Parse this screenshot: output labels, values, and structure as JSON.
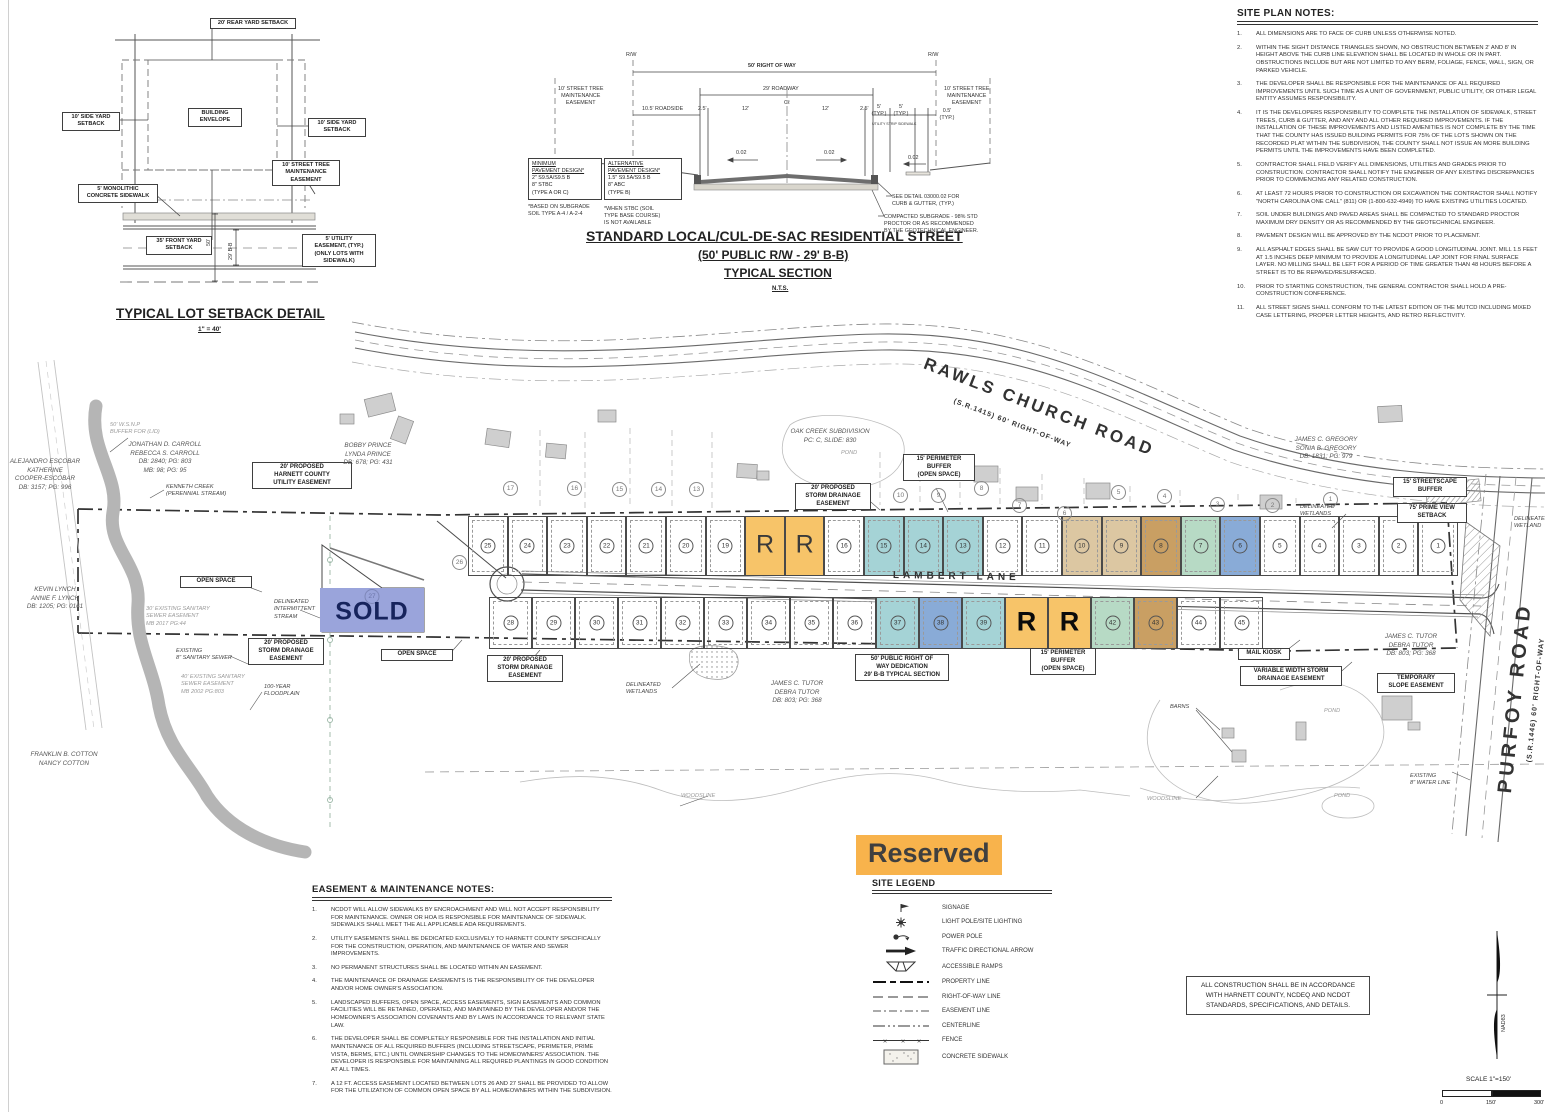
{
  "colors": {
    "teal": "#A5D3D6",
    "blue": "#89ABD7",
    "green": "#B7DAC5",
    "tan": "#DCC7A2",
    "tan_dark": "#C99F63",
    "orange": "#F7C469",
    "sold": "#9AA4DB",
    "reserved_bg": "#F8B34C"
  },
  "reserved_label": "Reserved",
  "setback_detail": {
    "title": "TYPICAL LOT SETBACK DETAIL",
    "scale": "1\" = 40'",
    "labels": {
      "rear": "20' REAR YARD SETBACK",
      "side_left": "10' SIDE YARD\nSETBACK",
      "side_right": "10' SIDE YARD\nSETBACK",
      "envelope": "BUILDING\nENVELOPE",
      "street_tree": "10' STREET TREE\nMAINTENANCE\nEASEMENT",
      "sidewalk": "5' MONOLITHIC\nCONCRETE SIDEWALK",
      "front": "35' FRONT YARD\nSETBACK",
      "utility": "5' UTILITY\nEASEMENT, (TYP.)\n(ONLY LOTS WITH\nSIDEWALK)",
      "dim50": "50'",
      "dim29": "29' B-B"
    }
  },
  "street_section": {
    "title1": "STANDARD LOCAL/CUL-DE-SAC RESIDENTIAL STREET",
    "title2": "(50' PUBLIC R/W - 29' B-B)",
    "title3": "TYPICAL SECTION",
    "nts": "N.T.S.",
    "rw_left": "R/W",
    "rw_right": "R/W",
    "row": "50' RIGHT OF WAY",
    "roadway": "29' ROADWAY",
    "maint_left": "10' STREET TREE\nMAINTENANCE\nEASEMENT",
    "maint_right": "10' STREET TREE\nMAINTENANCE\nEASEMENT",
    "roadside": "10.5' ROADSIDE",
    "d25a": "2.5'",
    "d12a": "12'",
    "cl": "Cℓ",
    "d12b": "12'",
    "d25b": "2.5'",
    "d5a": "5'\n(TYP.)",
    "utility_strip": "UTILITY STRIP",
    "d5b": "5'\n(TYP.)",
    "sidewalk_lbl": "SIDEWALK",
    "d05": "0.5'\n(TYP.)",
    "slope1": "0.02",
    "slope2": "0.02",
    "slope3": "0.02",
    "min_pavement": [
      "MINIMUM",
      "PAVEMENT DESIGN*",
      "2\" S9.5A/S9.5 B",
      "8\" STBC",
      "(TYPE A OR C)"
    ],
    "min_footnote": "*BASED ON SUBGRADE\nSOIL TYPE A-4 / A-2-4",
    "alt_pavement": [
      "ALTERNATIVE",
      "PAVEMENT DESIGN*",
      "1.5\" S9.5A/S9.5 B",
      "8\" ABC",
      "(TYPE B)"
    ],
    "alt_footnote": "*WHEN STBC (SOIL\nTYPE BASE COURSE)\nIS NOT AVAILABLE",
    "curb_callout": "SEE DETAIL 03000.02 FOR\nCURB & GUTTER, (TYP.)",
    "subgrade_callout": "COMPACTED SUBGRADE - 98% STD\nPROCTOR OR AS RECOMMENDED\nBY THE GEOTECHNICAL ENGINEER."
  },
  "site_plan_notes": {
    "title": "SITE PLAN NOTES:",
    "notes": [
      "ALL DIMENSIONS ARE TO FACE OF CURB UNLESS OTHERWISE NOTED.",
      "WITHIN THE SIGHT DISTANCE TRIANGLES SHOWN, NO OBSTRUCTION BETWEEN 2' AND 8' IN HEIGHT ABOVE THE CURB LINE ELEVATION SHALL BE LOCATED IN WHOLE OR IN PART. OBSTRUCTIONS INCLUDE BUT ARE NOT LIMITED TO ANY BERM, FOLIAGE, FENCE, WALL, SIGN, OR PARKED VEHICLE.",
      "THE DEVELOPER SHALL BE RESPONSIBLE FOR THE MAINTENANCE OF ALL REQUIRED IMPROVEMENTS UNTIL SUCH TIME AS A UNIT OF GOVERNMENT, PUBLIC UTILITY, OR OTHER LEGAL ENTITY ASSUMES RESPONSIBILITY.",
      "IT IS THE DEVELOPERS RESPONSIBILITY TO COMPLETE THE INSTALLATION OF SIDEWALK, STREET TREES, CURB & GUTTER, AND ANY AND ALL OTHER REQUIRED IMPROVEMENTS. IF THE INSTALLATION OF THESE IMPROVEMENTS AND LISTED AMENITIES IS NOT COMPLETE BY THE TIME THAT THE COUNTY HAS ISSUED BUILDING PERMITS FOR 75% OF THE LOTS SHOWN ON THE RECORDED PLAT WITHIN THE SUBDIVISION, THE COUNTY SHALL NOT ISSUE AN MORE BUILDING PERMITS UNTIL THE IMPROVEMENTS HAVE BEEN COMPLETED.",
      "CONTRACTOR SHALL FIELD VERIFY ALL DIMENSIONS, UTILITIES AND GRADES PRIOR TO CONSTRUCTION. CONTRACTOR SHALL NOTIFY THE ENGINEER OF ANY EXISTING DISCREPANCIES PRIOR TO COMMENCING ANY RELATED CONSTRUCTION.",
      "AT LEAST 72 HOURS PRIOR TO CONSTRUCTION OR EXCAVATION THE CONTRACTOR SHALL NOTIFY \"NORTH CAROLINA ONE CALL\" (811) OR (1-800-632-4949) TO HAVE EXISTING UTILITIES LOCATED.",
      "SOIL UNDER BUILDINGS AND PAVED AREAS SHALL BE COMPACTED TO STANDARD PROCTOR MAXIMUM DRY DENSITY OR AS RECOMMENDED BY THE GEOTECHNICAL ENGINEER.",
      "PAVEMENT DESIGN WILL BE APPROVED BY THE NCDOT PRIOR TO PLACEMENT.",
      "ALL ASPHALT EDGES SHALL BE SAW CUT TO PROVIDE A GOOD LONGITUDINAL JOINT.  MILL 1.5 FEET AT 1.5 INCHES DEEP MINIMUM TO PROVIDE A LONGITUDINAL LAP JOINT FOR FINAL SURFACE LAYER. NO MILLING SHALL BE LEFT FOR A PERIOD OF TIME GREATER THAN 48 HOURS BEFORE A STREET IS TO BE REPAVED/RESURFACED.",
      "PRIOR TO STARTING CONSTRUCTION, THE GENERAL CONTRACTOR SHALL HOLD A PRE-CONSTRUCTION CONFERENCE.",
      "ALL STREET SIGNS SHALL CONFORM TO THE LATEST EDITION OF THE MUTCD INCLUDING MIXED CASE LETTERING, PROPER LETTER HEIGHTS, AND RETRO REFLECTIVITY."
    ]
  },
  "easement_notes": {
    "title": "EASEMENT & MAINTENANCE NOTES:",
    "notes": [
      "NCDOT WILL ALLOW SIDEWALKS BY ENCROACHMENT AND WILL NOT ACCEPT RESPONSIBILITY FOR MAINTENANCE. OWNER OR HOA IS RESPONSIBLE FOR MAINTENANCE OF SIDEWALK. SIDEWALKS SHALL MEET THE ALL APPLICABLE ADA REQUIREMENTS.",
      "UTILITY EASEMENTS SHALL BE DEDICATED EXCLUSIVELY TO HARNETT COUNTY SPECIFICALLY FOR THE CONSTRUCTION, OPERATION, AND MAINTENANCE OF WATER AND SEWER IMPROVEMENTS.",
      "NO PERMANENT STRUCTURES SHALL BE LOCATED WITHIN AN EASEMENT.",
      "THE MAINTENANCE OF DRAINAGE EASEMENTS IS THE RESPONSIBILITY OF THE DEVELOPER AND/OR HOME OWNER'S ASSOCIATION.",
      "LANDSCAPED BUFFERS, OPEN SPACE, ACCESS EASEMENTS, SIGN EASEMENTS AND COMMON FACILITIES WILL BE RETAINED, OPERATED, AND MAINTAINED BY THE DEVELOPER AND/OR THE HOMEOWNER'S ASSOCIATION COVENANTS AND BY LAWS IN ACCORDANCE TO RELEVANT STATE LAW.",
      "THE DEVELOPER SHALL BE COMPLETELY RESPONSIBLE FOR THE INSTALLATION AND INITIAL MAINTENANCE OF ALL REQUIRED BUFFERS (INCLUDING STREETSCAPE, PERIMETER, PRIME VISTA, BERMS, ETC.) UNTIL OWNERSHIP CHANGES TO THE HOMEOWNERS' ASSOCIATION. THE DEVELOPER IS RESPONSIBLE FOR MAINTAINING ALL REQUIRED PLANTINGS IN GOOD CONDITION AT ALL TIMES.",
      "A 12 FT. ACCESS EASEMENT LOCATED BETWEEN LOTS 26 AND 27 SHALL BE PROVIDED TO ALLOW FOR THE UTILIZATION OF COMMON OPEN SPACE BY ALL HOMEOWNERS WITHIN THE SUBDIVISION."
    ]
  },
  "site_legend": {
    "title": "SITE LEGEND",
    "items": [
      {
        "symbol": "signage",
        "label": "SIGNAGE"
      },
      {
        "symbol": "light-pole",
        "label": "LIGHT POLE/SITE LIGHTING"
      },
      {
        "symbol": "power-pole",
        "label": "POWER POLE"
      },
      {
        "symbol": "traffic-arrow",
        "label": "TRAFFIC DIRECTIONAL ARROW"
      },
      {
        "symbol": "accessible-ramp",
        "label": "ACCESSIBLE RAMPS"
      },
      {
        "symbol": "property-line",
        "label": "PROPERTY LINE"
      },
      {
        "symbol": "row-line",
        "label": "RIGHT-OF-WAY LINE"
      },
      {
        "symbol": "easement-line",
        "label": "EASEMENT LINE"
      },
      {
        "symbol": "centerline",
        "label": "CENTERLINE"
      },
      {
        "symbol": "fence",
        "label": "FENCE"
      },
      {
        "symbol": "concrete-sidewalk",
        "label": "CONCRETE SIDEWALK"
      }
    ]
  },
  "construction_note": "ALL CONSTRUCTION SHALL BE IN ACCORDANCE\nWITH HARNETT COUNTY, NCDEQ AND NCDOT\nSTANDARDS, SPECIFICATIONS, AND DETAILS.",
  "north_arrow_label": "NAD83",
  "scale_bar": {
    "label": "SCALE 1\"=150'",
    "t0": "0",
    "t150": "150'",
    "t300": "300'"
  },
  "site_plan": {
    "roads": {
      "rawls": "RAWLS CHURCH ROAD",
      "rawls_sub": "(S.R.1415)  60' RIGHT-OF-WAY",
      "purfoy": "PURFOY ROAD",
      "purfoy_sub": "(S.R.1446)  60' RIGHT-OF-WAY",
      "lambert": "LAMBERT LANE"
    },
    "sold": {
      "num": "27",
      "label": "SOLD"
    },
    "lot_wedge": "26",
    "lots_north": [
      {
        "n": "25"
      },
      {
        "n": "24"
      },
      {
        "n": "23"
      },
      {
        "n": "22"
      },
      {
        "n": "21"
      },
      {
        "n": "20"
      },
      {
        "n": "19"
      },
      {
        "n": "R",
        "c": "orange"
      },
      {
        "n": "R",
        "c": "orange"
      },
      {
        "n": "16"
      },
      {
        "n": "15",
        "c": "teal"
      },
      {
        "n": "14",
        "c": "teal"
      },
      {
        "n": "13",
        "c": "teal"
      },
      {
        "n": "12"
      },
      {
        "n": "11"
      },
      {
        "n": "10",
        "c": "tan"
      },
      {
        "n": "9",
        "c": "tan"
      },
      {
        "n": "8",
        "c": "tan_dark"
      },
      {
        "n": "7",
        "c": "green"
      },
      {
        "n": "6",
        "c": "blue"
      },
      {
        "n": "5"
      },
      {
        "n": "4"
      },
      {
        "n": "3"
      },
      {
        "n": "2"
      },
      {
        "n": "1"
      }
    ],
    "lots_south": [
      {
        "n": "28"
      },
      {
        "n": "29"
      },
      {
        "n": "30"
      },
      {
        "n": "31"
      },
      {
        "n": "32"
      },
      {
        "n": "33"
      },
      {
        "n": "34"
      },
      {
        "n": "35"
      },
      {
        "n": "36"
      },
      {
        "n": "37",
        "c": "teal"
      },
      {
        "n": "38",
        "c": "blue"
      },
      {
        "n": "39",
        "c": "teal"
      },
      {
        "n": "R",
        "c": "orange"
      },
      {
        "n": "R",
        "c": "orange"
      },
      {
        "n": "42",
        "c": "green"
      },
      {
        "n": "43",
        "c": "tan_dark"
      },
      {
        "n": "44"
      },
      {
        "n": "45"
      }
    ],
    "neighbor_lots": [
      {
        "n": "17",
        "x": 503,
        "y": 481
      },
      {
        "n": "16",
        "x": 567,
        "y": 481
      },
      {
        "n": "15",
        "x": 612,
        "y": 482
      },
      {
        "n": "14",
        "x": 651,
        "y": 482
      },
      {
        "n": "13",
        "x": 689,
        "y": 482
      },
      {
        "n": "10",
        "x": 893,
        "y": 488
      },
      {
        "n": "9",
        "x": 931,
        "y": 488
      },
      {
        "n": "8",
        "x": 974,
        "y": 481
      },
      {
        "n": "7",
        "x": 1012,
        "y": 498
      },
      {
        "n": "6",
        "x": 1057,
        "y": 506
      },
      {
        "n": "5",
        "x": 1111,
        "y": 485
      },
      {
        "n": "4",
        "x": 1157,
        "y": 489
      },
      {
        "n": "3",
        "x": 1210,
        "y": 497
      },
      {
        "n": "2",
        "x": 1265,
        "y": 498
      },
      {
        "n": "1",
        "x": 1323,
        "y": 492
      },
      {
        "n": "26",
        "x": 452,
        "y": 555
      }
    ],
    "labels": [
      {
        "t": "20' PROPOSED\nHARNETT COUNTY\nUTILITY EASEMENT",
        "x": 252,
        "y": 462,
        "w": 92,
        "c": "lb-box"
      },
      {
        "t": "15' PERIMETER\nBUFFER\n(OPEN SPACE)",
        "x": 903,
        "y": 454,
        "w": 64,
        "c": "lb-box"
      },
      {
        "t": "20' PROPOSED\nSTORM DRAINAGE\nEASEMENT",
        "x": 795,
        "y": 483,
        "w": 68,
        "c": "lb-box"
      },
      {
        "t": "15' STREETSCAPE\nBUFFER",
        "x": 1393,
        "y": 477,
        "w": 66,
        "c": "lb-box"
      },
      {
        "t": "75' PRIME VIEW\nSETBACK",
        "x": 1397,
        "y": 503,
        "w": 62,
        "c": "lb-box"
      },
      {
        "t": "OPEN SPACE",
        "x": 180,
        "y": 576,
        "w": 64,
        "c": "lb-box"
      },
      {
        "t": "OPEN SPACE",
        "x": 381,
        "y": 649,
        "w": 64,
        "c": "lb-box"
      },
      {
        "t": "20' PROPOSED\nSTORM DRAINAGE\nEASEMENT",
        "x": 248,
        "y": 638,
        "w": 68,
        "c": "lb-box"
      },
      {
        "t": "20' PROPOSED\nSTORM DRAINAGE\nEASEMENT",
        "x": 487,
        "y": 655,
        "w": 68,
        "c": "lb-box"
      },
      {
        "t": "50' PUBLIC RIGHT OF\nWAY DEDICATION\n29' B-B TYPICAL SECTION",
        "x": 855,
        "y": 654,
        "w": 86,
        "c": "lb-box"
      },
      {
        "t": "15' PERIMETER\nBUFFER\n(OPEN SPACE)",
        "x": 1030,
        "y": 648,
        "w": 58,
        "c": "lb-box"
      },
      {
        "t": "MAIL KIOSK",
        "x": 1238,
        "y": 648,
        "w": 44,
        "c": "lb-box"
      },
      {
        "t": "VARIABLE WIDTH STORM\nDRAINAGE EASEMENT",
        "x": 1240,
        "y": 666,
        "w": 94,
        "c": "lb-box"
      },
      {
        "t": "TEMPORARY\nSLOPE EASEMENT",
        "x": 1377,
        "y": 673,
        "w": 70,
        "c": "lb-box"
      },
      {
        "t": "ALEJANDRO ESCOBAR\nKATHERINE\nCOOPER-ESCOBAR\nDB: 3157; PG: 996",
        "x": 4,
        "y": 458,
        "w": 82,
        "c": "lb-it"
      },
      {
        "t": "JONATHAN D. CARROLL\nREBECCA S. CARROLL\nDB: 2840; PG: 803\nMB: 98; PG: 95",
        "x": 120,
        "y": 441,
        "w": 90,
        "c": "lb-it"
      },
      {
        "t": "BOBBY PRINCE\nLYNDA PRINCE\nDB: 678; PG: 431",
        "x": 336,
        "y": 442,
        "w": 64,
        "c": "lb-it"
      },
      {
        "t": "KEVIN LYNCH\nANNIE F. LYNCH\nDB: 1205; PG: 0161",
        "x": 16,
        "y": 586,
        "w": 78,
        "c": "lb-it"
      },
      {
        "t": "FRANKLIN B. COTTON\nNANCY COTTON",
        "x": 22,
        "y": 751,
        "w": 84,
        "c": "lb-it"
      },
      {
        "t": "OAK CREEK SUBDIVISION\nPC: C, SLIDE: 830",
        "x": 783,
        "y": 428,
        "w": 94,
        "c": "lb-it"
      },
      {
        "t": "JAMES C. GREGORY\nSONIA B. GREGORY\nDB:    1831; PG: 979",
        "x": 1286,
        "y": 436,
        "w": 80,
        "c": "lb-it"
      },
      {
        "t": "JAMES C. TUTOR\nDEBRA TUTOR\nDB: 803; PG: 368",
        "x": 762,
        "y": 680,
        "w": 70,
        "c": "lb-it"
      },
      {
        "t": "JAMES C. TUTOR\nDEBRA TUTOR\nDB: 803; PG: 368",
        "x": 1376,
        "y": 633,
        "w": 70,
        "c": "lb-it"
      },
      {
        "t": "KENNETH CREEK\n(PERENNIAL STREAM)",
        "x": 166,
        "y": 484,
        "c": "lb-sm"
      },
      {
        "t": "DELINEATED\nINTERMITTENT\nSTREAM",
        "x": 274,
        "y": 599,
        "c": "lb-sm"
      },
      {
        "t": "30' EXISTING SANITARY\nSEWER EASEMENT\nMB 2017 PG:44",
        "x": 146,
        "y": 606,
        "c": "lb-smf"
      },
      {
        "t": "EXISTING\n8\" SANITARY SEWER",
        "x": 176,
        "y": 648,
        "c": "lb-sm"
      },
      {
        "t": "40' EXISTING SANITARY\nSEWER EASEMENT\nMB 2002 PG:803",
        "x": 181,
        "y": 674,
        "c": "lb-smf"
      },
      {
        "t": "100-YEAR\nFLOODPLAIN",
        "x": 264,
        "y": 684,
        "c": "lb-sm"
      },
      {
        "t": "50' W.S.N.P\nBUFFER FOR (LID)",
        "x": 110,
        "y": 422,
        "c": "lb-smf"
      },
      {
        "t": "DELINEATED\nWETLANDS",
        "x": 626,
        "y": 682,
        "c": "lb-sm"
      },
      {
        "t": "DELINEATED\nWETLANDS",
        "x": 1300,
        "y": 504,
        "c": "lb-sm"
      },
      {
        "t": "DELINEATED\nWETLAND",
        "x": 1514,
        "y": 516,
        "c": "lb-sm"
      },
      {
        "t": "BARNS",
        "x": 1170,
        "y": 704,
        "c": "lb-sm"
      },
      {
        "t": "POND",
        "x": 1324,
        "y": 708,
        "c": "lb-smf"
      },
      {
        "t": "POND",
        "x": 1334,
        "y": 793,
        "c": "lb-smf"
      },
      {
        "t": "POND",
        "x": 841,
        "y": 450,
        "c": "lb-smf"
      },
      {
        "t": "WOODSLINE",
        "x": 681,
        "y": 793,
        "c": "lb-smf"
      },
      {
        "t": "WOODSLINE",
        "x": 1147,
        "y": 796,
        "c": "lb-smf"
      },
      {
        "t": "EXISTING\n8\" WATER LINE",
        "x": 1410,
        "y": 773,
        "c": "lb-sm"
      },
      {
        "t": "RAWLS CHURCH ROAD",
        "x": 928,
        "y": 354,
        "c": "lb-road",
        "fs": 17,
        "ls": 3,
        "r": 21
      },
      {
        "t": "(S.R.1415)  60' RIGHT-OF-WAY",
        "x": 955,
        "y": 398,
        "c": "lb-road",
        "fs": 7,
        "ls": 1,
        "r": 21
      },
      {
        "t": "PURFOY ROAD",
        "x": 1494,
        "y": 792,
        "c": "lb-road",
        "fs": 20,
        "ls": 4,
        "r": -84
      },
      {
        "t": "(S.R.1446)  60' RIGHT-OF-WAY",
        "x": 1526,
        "y": 762,
        "c": "lb-road",
        "fs": 7,
        "ls": 1,
        "r": -84
      },
      {
        "t": "LAMBERT LANE",
        "x": 893,
        "y": 570,
        "c": "lb-road",
        "fs": 10,
        "ls": 4,
        "r": 1
      }
    ]
  }
}
